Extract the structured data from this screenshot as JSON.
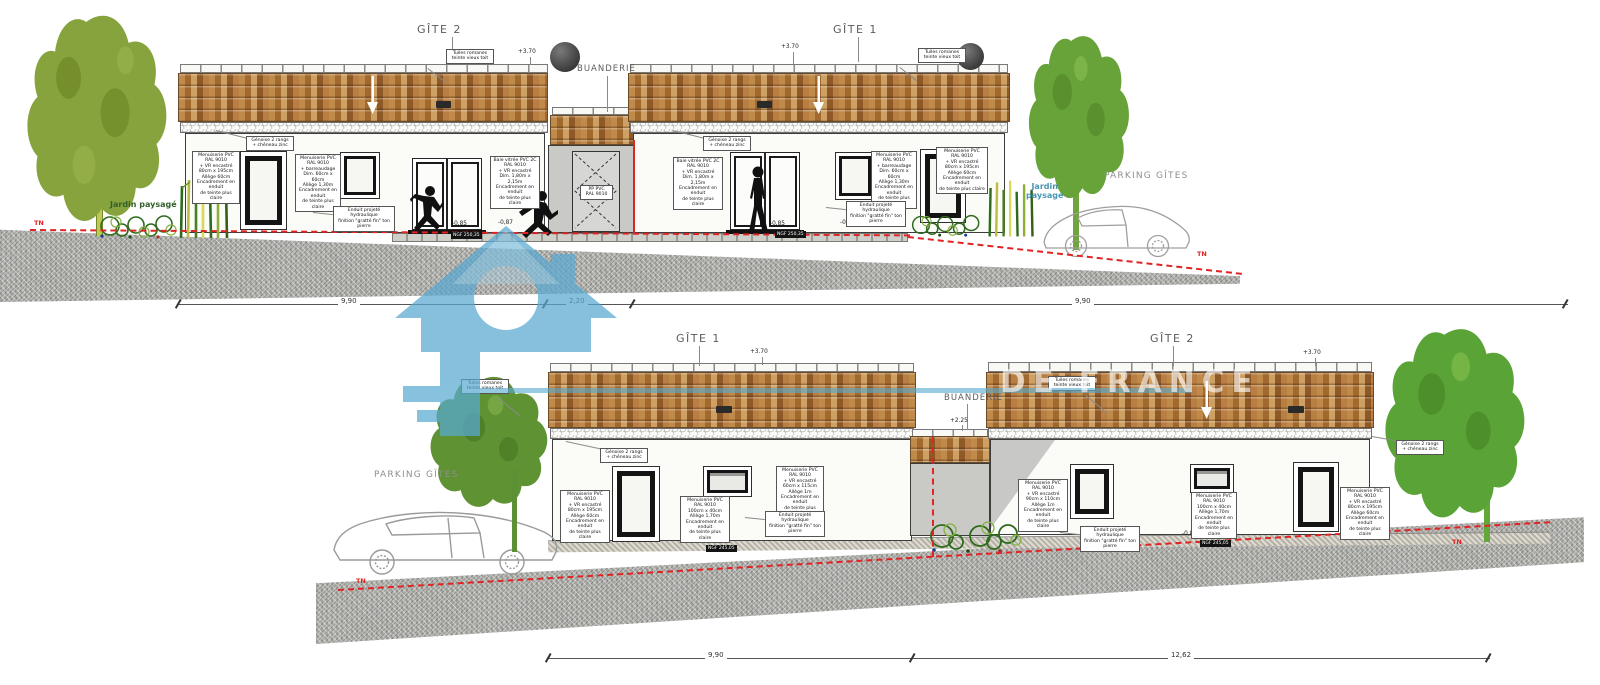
{
  "watermark": {
    "text": "DE FRANCE"
  },
  "colors": {
    "watermark_blue": "#58a9d1",
    "terrain_red": "#e02424",
    "roof_orange": "#b5803f",
    "jardin_green": "#34612b",
    "jardin_blue": "#4796b4"
  },
  "shared": {
    "tuiles": "Tuiles romanes\nteinte vieux toit",
    "genoise": "Génoise 2 rangs\n+ chéneau zinc",
    "enduit": "Enduit projeté hydraulique\nfinition \"gratté fin\" ton pierre",
    "tn": "TN",
    "parking": "PARKING GÎTES",
    "ann_tall": "Menuiserie PVC\nRAL 9010\n+ VR encastré\n80cm x 195cm\nAllège 60cm\nEncadrement en enduit\nde teinte plus claire",
    "ann_small_barreau": "Menuiserie PVC\nRAL 9010\n+ barreaudage\nDim. 60cm x 60cm\nAllège 1,30m\nEncadrement en enduit\nde teinte plus claire",
    "ann_baie": "Baie vitrée PVC 2C\nRAL 9010\n+ VR encastré\nDim. 1,80m x 2,15m\nEncadrement en enduit\nde teinte plus claire",
    "ann_wide": "Menuiserie PVC\nRAL 9010\n100cm x 40cm\nAllège 1,70m\nEncadrement en enduit\nde teinte plus claire",
    "ann_mid": "Menuiserie PVC\nRAL 9010\n+ VR encastré\n60cm x 115cm\nAllège 1m\nEncadrement en enduit\nde teinte plus claire",
    "ann_mid2": "Menuiserie PVC\nRAL 9010\n+ VR encastré\n90cm x 110cm\nAllège 1m\nEncadrement en enduit\nde teinte plus claire",
    "door_pp": "PP PVC\nRAL 9010"
  },
  "top": {
    "gite_left": "GÎTE 2",
    "gite_right": "GÎTE 1",
    "buanderie": "BUANDERIE",
    "ridge_level": "+3.70",
    "jardin_left": "Jardin paysagé",
    "jardin_right": "Jardin\npaysagé",
    "lvl_085": "-0,85",
    "lvl_087": "-0,87",
    "ngf": "NGF 250,35",
    "dims": [
      "9,90",
      "2,20",
      "9,90"
    ]
  },
  "bottom": {
    "gite_left": "GÎTE 1",
    "gite_right": "GÎTE 2",
    "buanderie": "BUANDERIE",
    "ridge_level": "+3.70",
    "buanderie_level": "+2.25",
    "lvl_085": "-0,85",
    "ngf": "NGF 245,05",
    "dims": [
      "9,90",
      "12,62"
    ]
  }
}
